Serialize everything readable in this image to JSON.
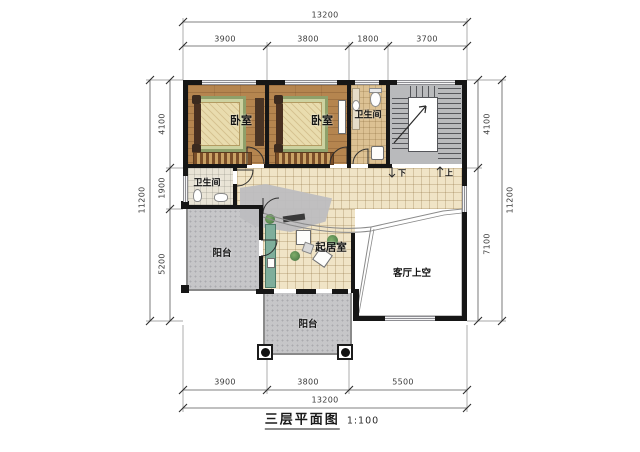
{
  "title": {
    "name": "三层平面图",
    "scale": "1:100"
  },
  "dimensions": {
    "top": {
      "total": "13200",
      "segments": [
        "3900",
        "3800",
        "1800",
        "3700"
      ]
    },
    "bottom": {
      "total": "13200",
      "segments": [
        "3900",
        "3800",
        "5500"
      ]
    },
    "left": {
      "total": "11200",
      "segments": [
        "4100",
        "1900",
        "5200"
      ]
    },
    "right": {
      "total": "11200",
      "segments": [
        "4100",
        "7100"
      ]
    }
  },
  "rooms": {
    "bedroom_left": "卧室",
    "bedroom_mid": "卧室",
    "bathroom_top": "卫生间",
    "bathroom_left": "卫生间",
    "living": "起居室",
    "void": "客厅上空",
    "balcony_left": "阳台",
    "balcony_bottom": "阳台",
    "stair_down": "下",
    "stair_up": "上"
  },
  "colors": {
    "wall": "#161616",
    "wood_floor": "#b5854f",
    "tile_floor": "#f0e4c6",
    "bath_floor": "#dcc193",
    "balcony": "#c6c6c8",
    "stair": "#b9babc",
    "rug_green": "#8fa06a",
    "accent_teal": "#7fae9b"
  }
}
